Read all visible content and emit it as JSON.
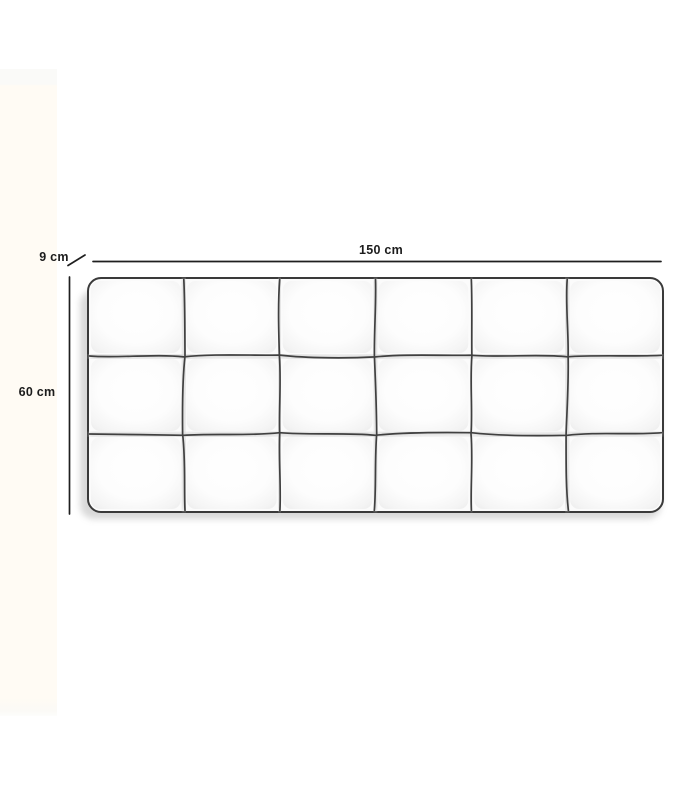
{
  "diagram": {
    "subject": "tufted-headboard-dimension-diagram",
    "width_label": "150 cm",
    "height_label": "60 cm",
    "depth_label": "9 cm",
    "dimensions": {
      "width_cm": 150,
      "height_cm": 60,
      "depth_cm": 9
    },
    "tufting": {
      "columns": 6,
      "rows": 3
    },
    "colors": {
      "background": "#ffffff",
      "side_strip": "#fffbf4",
      "headboard_fill": "#fbfbfb",
      "outline": "#3a3a3a",
      "seam": "#404040",
      "seam_shade": "#d9d9d9",
      "dimension_line": "#1f1f1f",
      "label_text": "#1c1c1c",
      "shadow": "#999999"
    }
  }
}
